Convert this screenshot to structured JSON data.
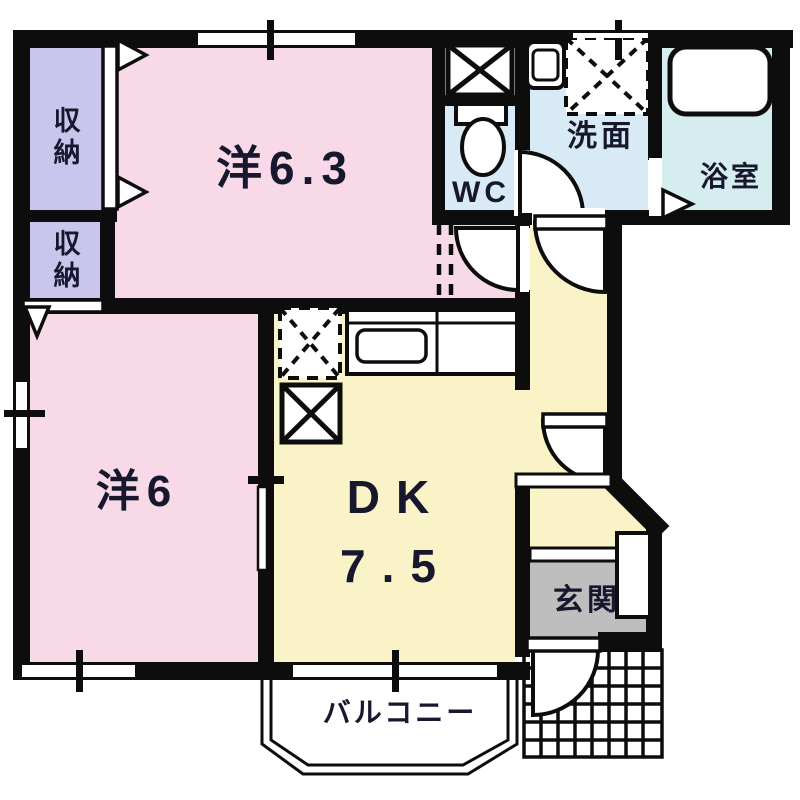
{
  "plan_title": "1DK apartment floor plan",
  "rooms": {
    "western_63": {
      "label": "洋6.3"
    },
    "western_6": {
      "label": "洋6"
    },
    "dk": {
      "label": "DK",
      "size": "7.5"
    },
    "wc": {
      "label": "WC"
    },
    "washroom": {
      "label": "洗面"
    },
    "bathroom": {
      "label": "浴室"
    },
    "entrance": {
      "label": "玄関"
    },
    "balcony": {
      "label": "バルコニー"
    },
    "closet_upper": {
      "label": "収納"
    },
    "closet_lower": {
      "label": "収納"
    }
  },
  "colors": {
    "wall": "#0d0d0d",
    "western_room": "#f8d9e7",
    "closet": "#c9c5ec",
    "dk_hall": "#faf3c8",
    "wet_area": "#d8eaf5",
    "bathroom": "#d5edee",
    "entrance_floor": "#bebebe",
    "line": "#0d0d0d"
  }
}
